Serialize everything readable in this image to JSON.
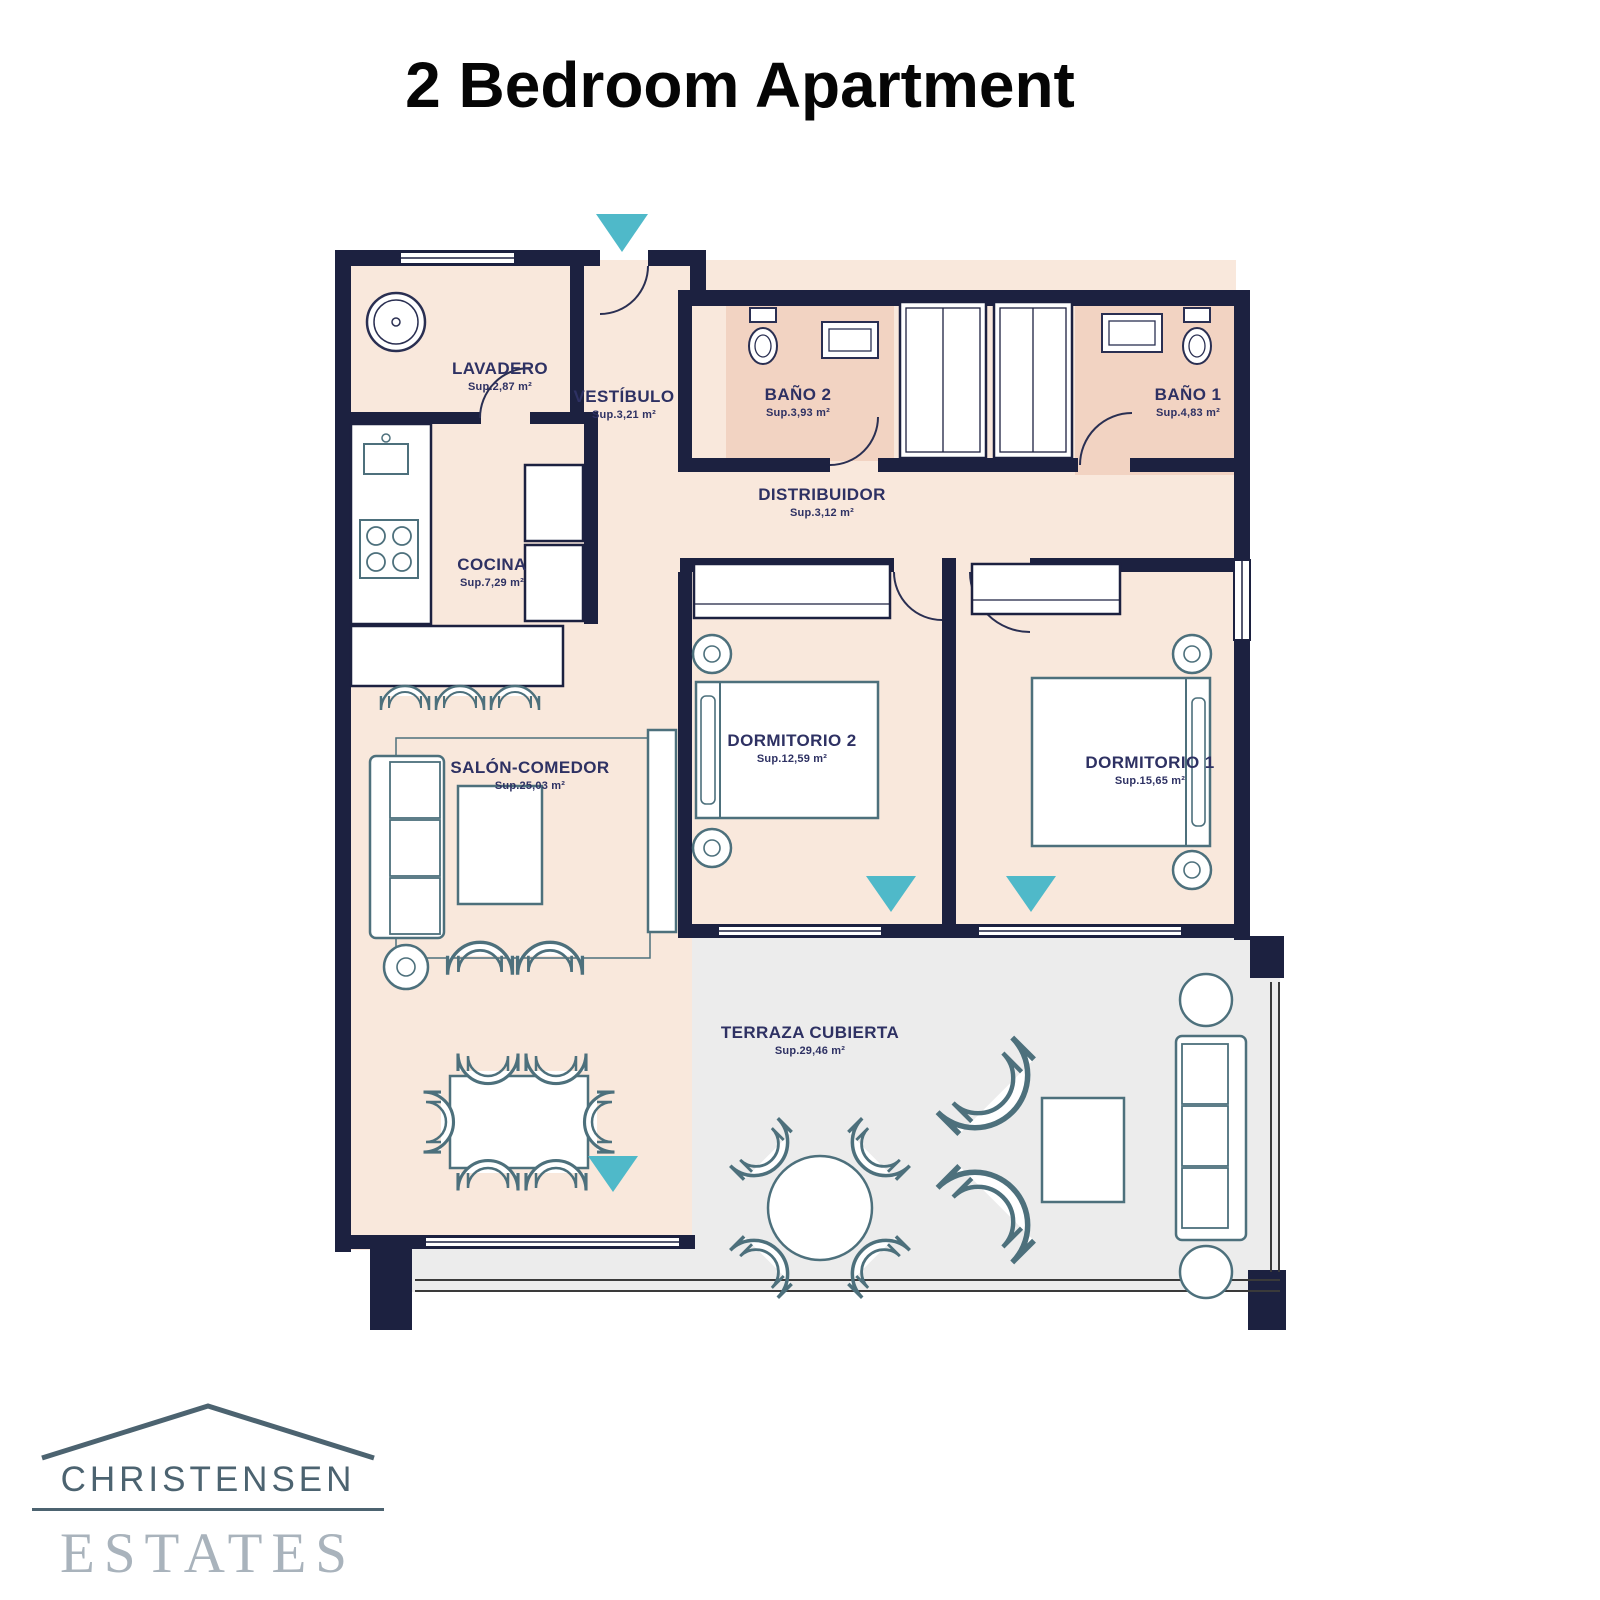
{
  "title": "2 Bedroom Apartment",
  "plan": {
    "rooms": [
      {
        "id": "lavadero",
        "name": "LAVADERO",
        "sup": "Sup.2,87 m²"
      },
      {
        "id": "vestibulo",
        "name": "VESTÍBULO",
        "sup": "Sup.3,21 m²"
      },
      {
        "id": "bano2",
        "name": "BAÑO 2",
        "sup": "Sup.3,93 m²"
      },
      {
        "id": "bano1",
        "name": "BAÑO 1",
        "sup": "Sup.4,83 m²"
      },
      {
        "id": "distribuidor",
        "name": "DISTRIBUIDOR",
        "sup": "Sup.3,12 m²"
      },
      {
        "id": "cocina",
        "name": "COCINA",
        "sup": "Sup.7,29 m²"
      },
      {
        "id": "dormitorio2",
        "name": "DORMITORIO 2",
        "sup": "Sup.12,59 m²"
      },
      {
        "id": "dormitorio1",
        "name": "DORMITORIO 1",
        "sup": "Sup.15,65 m²"
      },
      {
        "id": "salon",
        "name": "SALÓN-COMEDOR",
        "sup": "Sup.25,03 m²"
      },
      {
        "id": "terraza",
        "name": "TERRAZA CUBIERTA",
        "sup": "Sup.29,46 m²"
      }
    ],
    "colors": {
      "wall": "#1c2140",
      "floor": "#f9e8dc",
      "bathroom_floor": "#f2d3c2",
      "terrace_floor": "#ececec",
      "furniture_stroke": "#4d707c",
      "entry_arrow": "#4fb9c9",
      "label_text": "#2e3163"
    }
  },
  "logo": {
    "line1": "CHRISTENSEN",
    "line2": "ESTATES"
  }
}
